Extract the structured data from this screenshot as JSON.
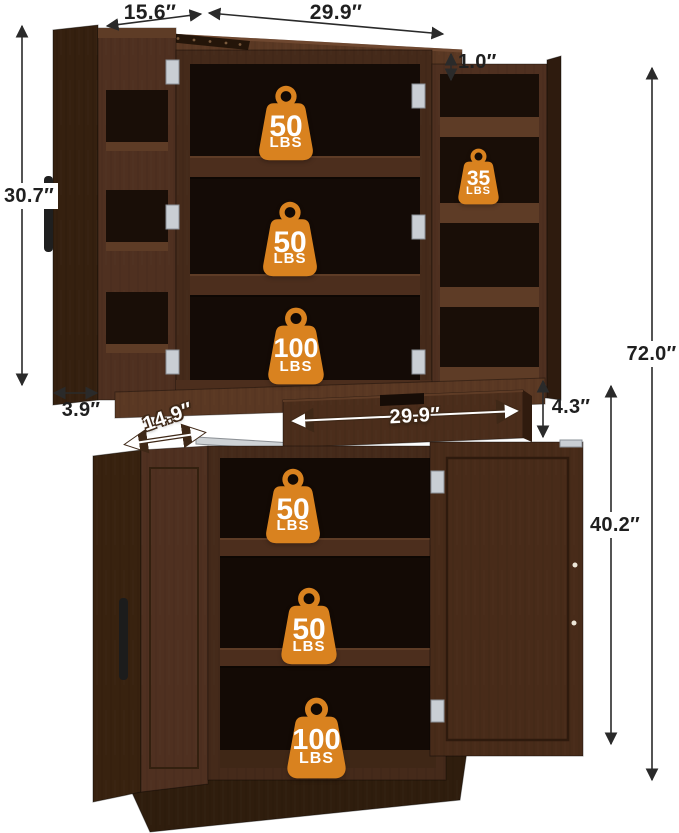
{
  "dimensions": {
    "top_depth": "15.6″",
    "top_width": "29.9″",
    "top_overhang": "1.0″",
    "upper_section_height": "30.7″",
    "upper_side_depth": "3.9″",
    "drawer_depth": "14.9″",
    "drawer_width": "29.9″",
    "drawer_height": "4.3″",
    "lower_section_height": "40.2″",
    "overall_height": "72.0″"
  },
  "weights": {
    "upper_shelves": [
      {
        "value": "50",
        "unit": "LBS"
      },
      {
        "value": "50",
        "unit": "LBS"
      },
      {
        "value": "100",
        "unit": "LBS"
      }
    ],
    "door_shelf": {
      "value": "35",
      "unit": "LBS"
    },
    "lower_shelves": [
      {
        "value": "50",
        "unit": "LBS"
      },
      {
        "value": "50",
        "unit": "LBS"
      },
      {
        "value": "100",
        "unit": "LBS"
      }
    ]
  },
  "colors": {
    "badge_orange": "#D9821F",
    "wood_dark": "#33200F",
    "wood_mid": "#4A2D1C",
    "wood_light": "#5A3823",
    "interior_dark": "#150C06",
    "dimension_text": "#1F1F1F",
    "metal": "#C9CED4"
  }
}
